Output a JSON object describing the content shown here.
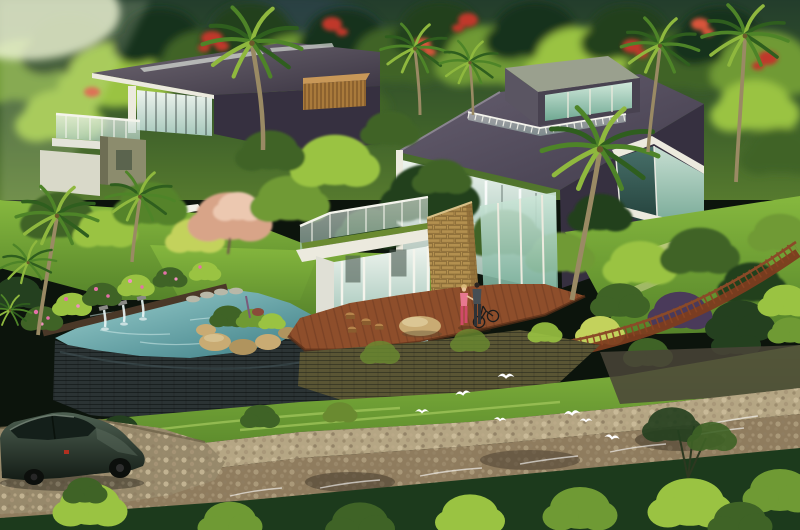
{
  "scene": {
    "type": "architectural-landscape-rendering",
    "description": "Aerial rendering of two modern flat-roof glass villas on a forested tropical hillside with an infinity rock pool, wooden deck, curved timber boardwalk, palm trees, flowering shrubs, white egrets, a pebbly stream and a dark green sedan on a gravel drive",
    "counts": {
      "villas": 2,
      "water_spouts": 3,
      "egrets": 7,
      "palm_trees": 8,
      "people": 2,
      "bicycles": 1,
      "cars": 1
    },
    "elements": [
      "forest-hillside-background",
      "sunlight-haze",
      "flame-tree-blossoms",
      "left-villa",
      "left-villa-roof",
      "roof-skylight",
      "glass-curtain-wall",
      "terrace-glass-balustrade",
      "olive-wall-volume",
      "wood-slat-screen",
      "right-villa",
      "right-villa-roof",
      "rooftop-glass-penthouse",
      "roof-terrace-railing",
      "curtain-glass-facade",
      "angular-glass-bay",
      "amber-lit-window",
      "glass-pavilion",
      "pavilion-roof-planter",
      "stone-feature-wall",
      "white-steps",
      "infinity-pool",
      "pool-stone-wall",
      "pool-rim",
      "water-spout",
      "stepping-stones",
      "rock-island",
      "island-planting",
      "overflow-waterfall",
      "wooden-deck",
      "deck-stool",
      "sandstone-boulder",
      "woman-figure",
      "man-figure",
      "bicycle",
      "curved-boardwalk",
      "timber-railing-fence",
      "moss-retaining-wall",
      "red-flower-bed",
      "yucca-plants",
      "pink-flowering-shrub",
      "smoke-tree",
      "garden-tree",
      "lawn",
      "garden-path",
      "lounge-chair",
      "grass-bank",
      "pebble-shore",
      "rocky-stream",
      "stream-rapids",
      "deep-green-water",
      "bottom-tree-canopy",
      "gravel-driveway",
      "green-sedan",
      "egret"
    ]
  },
  "palette": {
    "forest_deep": "#18301a",
    "forest_dark": "#24401f",
    "forest_mid": "#3f6326",
    "forest_light": "#6f9a34",
    "foliage_bright": "#9ac342",
    "foliage_yellow": "#c3d25c",
    "blue_shade": "#33455e",
    "haze_light": "#eef4d4",
    "flame_red": "#c0392b",
    "flame_red_light": "#d9543a",
    "roof_dark": "#363040",
    "roof_mid": "#534c58",
    "roof_edge": "#8a8490",
    "cube_top": "#9aa08e",
    "cube_side": "#5a5562",
    "white_trim": "#eceade",
    "olive_wall": "#8c8c6d",
    "olive_dark": "#6e6e54",
    "wood_slat": "#a97a3b",
    "wood_slat_light": "#c89858",
    "stone_tan": "#b3904f",
    "stone_tan_dark": "#8a6a36",
    "pool_wall": "#2b3334",
    "pool_rim_brown": "#4a3828",
    "rock_sand": "#c9ab73",
    "rock_sand_dark": "#b0945e",
    "deck_wood": "#8e4e2b",
    "deck_wood_dark": "#6d3a20",
    "fence_wood": "#7c3c1f",
    "lawn_bright": "#7cb13c",
    "lawn_dark": "#55832a",
    "stream_bed": "#8f7c5e",
    "stream_dark": "#463a2c",
    "stream_light": "#b5a684",
    "bottom_water": "#1c3a1c",
    "car_glass": "#141f1a",
    "person_pink": "#d04a68",
    "person_pink_light": "#e87890",
    "person_dark": "#464e54",
    "skin": "#e8c39a",
    "hair_blonde": "#d8b878",
    "bird_white": "#ffffff",
    "moss_green": "#6a8a30",
    "moss_wall": "#5a5534",
    "flower_pink": "#e470a8",
    "flower_red": "#cc2e2e",
    "palm_trunk": "#9a8a64",
    "palm_green_dark": "#2f5e1e",
    "palm_green_mid": "#4e8428",
    "palm_green_light": "#8fb83e",
    "amber_window": "#c0a05a",
    "purple_shrub": "#4a3a5a",
    "smoke_pink": "#d8a488",
    "smoke_pink_light": "#ecc8b0",
    "stone_grey": "#b8b8a8"
  }
}
